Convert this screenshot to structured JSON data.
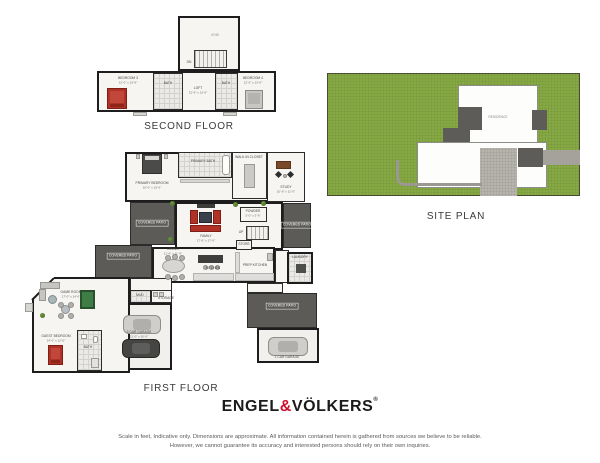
{
  "titles": {
    "second_floor": "SECOND FLOOR",
    "first_floor": "FIRST FLOOR",
    "site_plan": "SITE PLAN"
  },
  "brand": {
    "name_left": "ENGEL",
    "ampersand": "&",
    "name_right": "VÖLKERS",
    "registered": "®",
    "accent_color": "#CE0E2D"
  },
  "disclaimer": {
    "line1": "Scale in feet, Indicative only. Dimensions are approximate. All information contained herein is gathered from sources we believe to be reliable.",
    "line2": "However, we cannot guarantee its accuracy and interested persons should rely on their own inquiries."
  },
  "site_plan": {
    "residence": "RESIDENCE",
    "colors": {
      "lawn": "#86A845",
      "patio": "#5D5C59",
      "driveway": "#A5A29B",
      "courtyard": "#B6B3AC"
    }
  },
  "second_floor": {
    "void": "VOID",
    "dn": "DN",
    "bedroom3": {
      "name": "BEDROOM 3",
      "dims": "12'-0\" x 13'-6\""
    },
    "bath3": "BATH",
    "loft": {
      "name": "LOFT",
      "dims": "12'-6\" x 13'-6\""
    },
    "bath4": "BATH",
    "bedroom4": {
      "name": "BEDROOM 4",
      "dims": "12'-0\" x 13'-6\""
    }
  },
  "first_floor": {
    "primary_bedroom": {
      "name": "PRIMARY BEDROOM",
      "dims": "16'-0\" x 15'-6\""
    },
    "primary_bath": "PRIMARY BATH",
    "walk_in_closet": "WALK-IN CLOSET",
    "study": {
      "name": "STUDY",
      "dims": "10'-6\" x 11'-0\""
    },
    "powder": {
      "name": "POWDER",
      "dims": "5'-0\" x 5'-6\""
    },
    "family": {
      "name": "FAMILY",
      "dims": "17'-6\" x 17'-0\""
    },
    "dining": {
      "name": "DINING",
      "dims": "11'-6\" x 11'-0\""
    },
    "kitchen": "KITCHEN",
    "prep_kitchen": "PREP KITCHEN",
    "store": "STORE",
    "up": "UP",
    "laundry": "LAUNDRY",
    "covered_patio": "COVERED PATIO",
    "game_room": {
      "name": "GAME ROOM",
      "dims": "17'-0\" x 14'-0\""
    },
    "guest_bedroom": {
      "name": "GUEST BEDROOM",
      "dims": "14'-0\" x 12'-0\""
    },
    "guest_bath": "BATH",
    "mud": "MUD",
    "storage": "STORAGE",
    "garage_2car": {
      "name": "2 CAR GARAGE",
      "dims": "21'-0\" x 20'-0\""
    },
    "garage_1car": "1 CAR GARAGE"
  }
}
